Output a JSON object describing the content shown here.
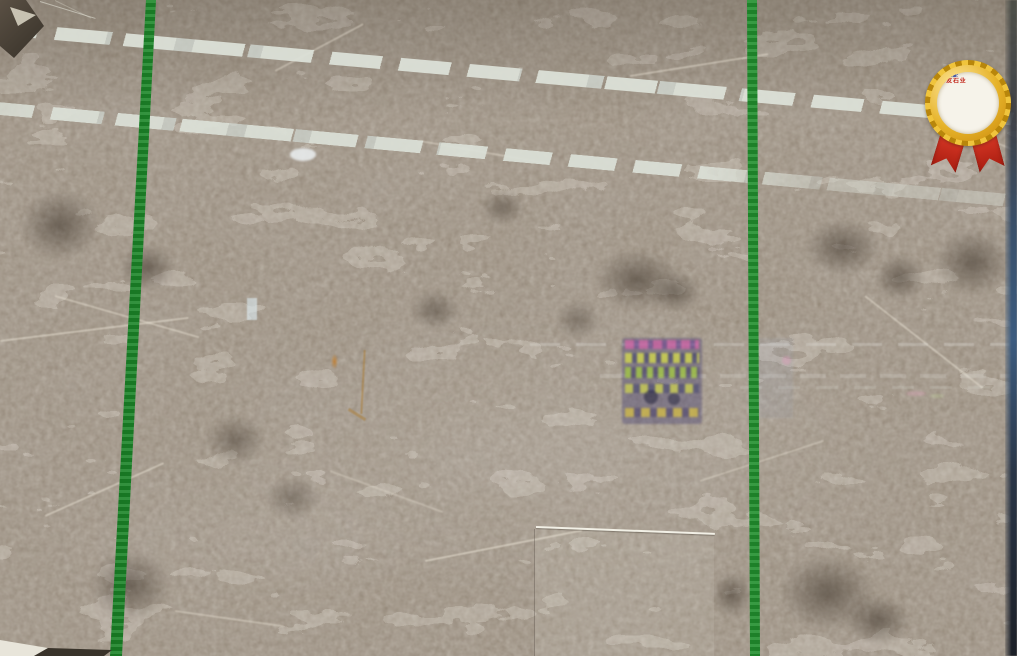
{
  "scene": {
    "subject": "Large polished grey-brown marble slab (emperador-grey style) standing in a stone warehouse",
    "details": "Two bright green packing straps cross the slab vertically; ceiling fluorescent tubes reflect as two diagonal dashed white bands; window and a colorful sign reflect faintly in the polished surface; a smaller slab leans in front at bottom centre; gold prize rosette label sticker at top right"
  },
  "palette": {
    "marble_base": "#93897b",
    "marble_dark_blotch": "#574d41",
    "marble_vein": "#e6dfd0",
    "strap_green": "#2fae3c",
    "light_band": "#dee3da",
    "edge_strip_blue": "#3c5c80",
    "front_slab_edge_highlight": "#f2f0e6"
  },
  "straps": {
    "count": 2,
    "color": "#2fae3c"
  },
  "reflections": {
    "light_bands": 2,
    "band_color": "#dee3da",
    "window_pane_color": "#deecf4",
    "sign": {
      "background": "#3a346e",
      "dash_yellow": "#cdd34a",
      "dash_green": "#a0c83e",
      "top_strip_magenta": "#d45ea8"
    }
  },
  "badge": {
    "title": "三友石业",
    "title_color": "#c22418",
    "lines": [
      "品名:",
      "编号:",
      "规格:",
      "数量:",
      "日期:"
    ],
    "line_color": "#3f54a6",
    "gold_color": "#e6b32a",
    "ribbon_color": "#d6301d"
  }
}
